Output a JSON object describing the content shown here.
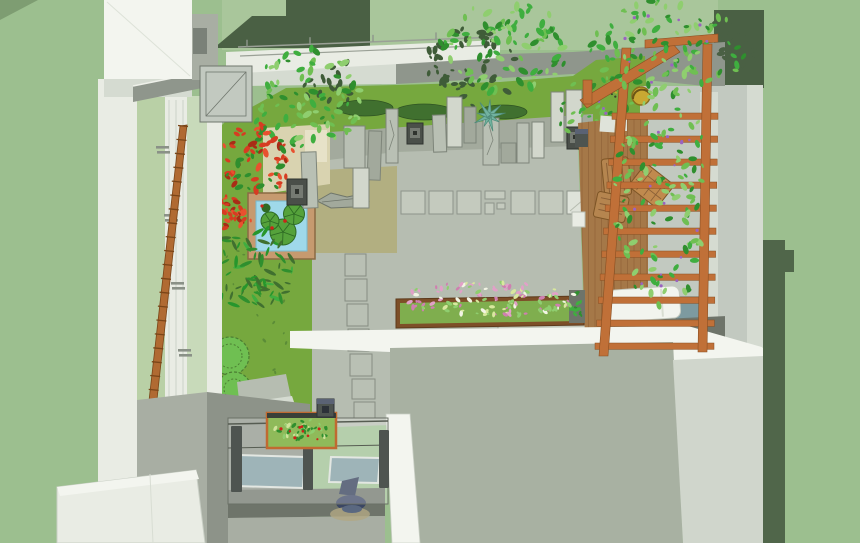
{
  "meta": {
    "width": 860,
    "height": 543
  },
  "scene": {
    "description": "Axonometric 3D rendering of a courtyard roof garden beside a glazed house facade",
    "objects": [
      {
        "name": "house-facade",
        "color": "wall_white"
      },
      {
        "name": "glass-curtain-wall",
        "color": "window_green"
      },
      {
        "name": "leaning-ladder",
        "color": "ladder"
      },
      {
        "name": "lawn",
        "color": "lawn"
      },
      {
        "name": "square-pond-with-lilypads",
        "color": "pond_water"
      },
      {
        "name": "red-maple-shrubs",
        "color": "red1"
      },
      {
        "name": "standing-stones",
        "color": "stone"
      },
      {
        "name": "stone-lanterns",
        "color": "lantern"
      },
      {
        "name": "agave-plant",
        "color": "agave"
      },
      {
        "name": "moss-mounds",
        "color": "moss"
      },
      {
        "name": "gray-patio-with-pavers",
        "color": "patio"
      },
      {
        "name": "stepping-stones",
        "color": "stone"
      },
      {
        "name": "flowering-planter",
        "color": "planter_green"
      },
      {
        "name": "wood-deck",
        "color": "deck"
      },
      {
        "name": "pergola-trellis-with-vines",
        "color": "pergola"
      },
      {
        "name": "white-lounge-bed",
        "color": "white_furniture"
      },
      {
        "name": "wooden-chairs",
        "color": "chair_wood"
      },
      {
        "name": "glass-lightwell",
        "color": "glass_teal"
      },
      {
        "name": "aquarium-planter-box",
        "color": "aqua_green"
      },
      {
        "name": "lower-roof",
        "color": "roof"
      }
    ]
  },
  "palette": {
    "background": "#9cbf8f",
    "corner_shade": "#7e9d72",
    "hedge_light": "#a9c69b",
    "dark_foliage": "#4a6044",
    "dark_foliage2": "#50664a",
    "band_gray": "#8f968c",
    "wall_white": "#e9ece4",
    "wall_bright": "#f3f5ef",
    "wall_light": "#d5dbd1",
    "wall_gray": "#c2c9c0",
    "wall_mid": "#a8aea3",
    "wall_dark": "#8d9389",
    "window_dark": "#7a8178",
    "window_green": "#b9d0a6",
    "window_green2": "#c8daba",
    "lawn": "#76a83e",
    "patio": "#b6bdb1",
    "patio_dark": "#a3aa9d",
    "olive": "#b2af81",
    "tan": "#d9d3b0",
    "tan_light": "#e7e2c8",
    "paver": "#c4cabe",
    "paver_light": "#dfe3da",
    "stone": "#b9c0b4",
    "stone_light": "#d2d7cc",
    "stone_dark": "#a2a99c",
    "stone_outline": "#7e857a",
    "roof": "#a8b1a2",
    "parapet": "#d0d6cc",
    "pergola": "#c07038",
    "pergola_dark": "#8a4f22",
    "ladder": "#b06a32",
    "deck": "#a57848",
    "deck_line": "#875c33",
    "wood_frame": "#7d4f28",
    "planter_green": "#7fae4e",
    "pond_frame": "#c69a6f",
    "pond_water": "#9fd9ea",
    "lily": "#55a23b",
    "lily_dark": "#2e6b24",
    "leaf1": "#3fae3f",
    "leaf2": "#6fbf52",
    "leaf3": "#2f8f2e",
    "leaf4": "#8fce6f",
    "leaf_dark": "#3f5c38",
    "fern": "#27962c",
    "moss": "#40702f",
    "red1": "#d63c22",
    "red2": "#e8512f",
    "red3": "#a82c16",
    "flower_pink": "#e2a0c8",
    "flower_pink2": "#cf7fb0",
    "flower_light": "#d8e89e",
    "flower_white": "#f2f4e4",
    "purple": "#9a63c0",
    "agave": "#72b3a0",
    "bird_dark": "#3a3f2e",
    "yellow": "#c9a832",
    "lantern": "#4a4f49",
    "lantern_inner": "#757a72",
    "glass_teal": "#7d9aa0",
    "glass_tint": "rgba(255,255,255,0.26)",
    "post_dark": "#4e5450",
    "floor_dark": "#6e746a",
    "aqua_green": "#8fba5a",
    "aqua_leaf": "#cfe39a",
    "red_fruit": "#cc2418",
    "navy": "#3a4663",
    "navy2": "#2e3a56",
    "navy3": "#5a6880",
    "shadow_tan": "#b2a883",
    "white_furniture": "#f2f4ee",
    "chair_wood": "#b5854f",
    "chair_wood2": "#c08a4e",
    "shadow_soft": "#8a9183"
  },
  "foliage_clusters": [
    {
      "name": "shadow-canopy",
      "cx": 472,
      "cy": 68,
      "rx": 48,
      "ry": 40,
      "count": 48,
      "smin": 2,
      "smax": 5,
      "shape": "leaf",
      "colors": [
        "leaf_dark"
      ],
      "seed": 7
    },
    {
      "name": "shadow-tree-left",
      "cx": 332,
      "cy": 82,
      "rx": 30,
      "ry": 26,
      "count": 20,
      "smin": 2,
      "smax": 4.5,
      "shape": "leaf",
      "colors": [
        "leaf_dark"
      ],
      "seed": 11
    },
    {
      "name": "pergola-shadow-leaves",
      "cx": 733,
      "cy": 42,
      "rx": 26,
      "ry": 30,
      "count": 26,
      "smin": 2,
      "smax": 4.5,
      "shape": "leaf",
      "colors": [
        "dark_foliage"
      ],
      "seed": 89
    },
    {
      "name": "lawn-specks",
      "cx": 260,
      "cy": 300,
      "rx": 48,
      "ry": 115,
      "count": 22,
      "smin": 1,
      "smax": 2.4,
      "shape": "leaf",
      "colors": [
        "moss"
      ],
      "seed": 59,
      "opacity": 0.5
    },
    {
      "name": "tree-left",
      "cx": 306,
      "cy": 98,
      "rx": 56,
      "ry": 50,
      "count": 80,
      "smin": 2.2,
      "smax": 5.5,
      "shape": "leaf",
      "colors": [
        "leaf1",
        "leaf2",
        "leaf3",
        "leaf4"
      ],
      "seed": 13
    },
    {
      "name": "tree-center",
      "cx": 505,
      "cy": 47,
      "rx": 68,
      "ry": 46,
      "count": 90,
      "smin": 2.2,
      "smax": 5.5,
      "shape": "leaf",
      "colors": [
        "leaf1",
        "leaf3",
        "leaf2",
        "leaf4"
      ],
      "seed": 17
    },
    {
      "name": "shrubs-right",
      "cx": 602,
      "cy": 112,
      "rx": 46,
      "ry": 36,
      "count": 55,
      "smin": 2,
      "smax": 5,
      "shape": "leaf",
      "colors": [
        "leaf2",
        "leaf3",
        "leaf1"
      ],
      "seed": 19
    },
    {
      "name": "shrubs-right-flowers",
      "cx": 604,
      "cy": 116,
      "rx": 42,
      "ry": 32,
      "count": 10,
      "smin": 2,
      "smax": 3.4,
      "shape": "dot",
      "colors": [
        "purple"
      ],
      "seed": 23
    },
    {
      "name": "red-tree-large",
      "cx": 258,
      "cy": 159,
      "rx": 37,
      "ry": 34,
      "count": 70,
      "smin": 2,
      "smax": 5,
      "shape": "leaf",
      "colors": [
        "red1",
        "red2",
        "red3",
        "red1",
        "leaf3"
      ],
      "seed": 43
    },
    {
      "name": "red-tree-small",
      "cx": 231,
      "cy": 215,
      "rx": 21,
      "ry": 19,
      "count": 40,
      "smin": 1.8,
      "smax": 4.2,
      "shape": "leaf",
      "colors": [
        "red1",
        "red2",
        "red3"
      ],
      "seed": 47
    },
    {
      "name": "fern-left",
      "cx": 251,
      "cy": 269,
      "rx": 44,
      "ry": 40,
      "count": 70,
      "smin": 3,
      "smax": 7,
      "shape": "frond",
      "colors": [
        "fern",
        "leaf3",
        "leaf1",
        "moss"
      ],
      "seed": 53
    },
    {
      "name": "planter-flowers",
      "cx": 489,
      "cy": 299,
      "rx": 91,
      "ry": 17,
      "count": 115,
      "smin": 1.5,
      "smax": 3.4,
      "shape": "leaf",
      "colors": [
        "flower_light",
        "flower_pink",
        "flower_pink2",
        "flower_white",
        "leaf4"
      ],
      "seed": 61
    },
    {
      "name": "deck-pot-plants",
      "cx": 577,
      "cy": 306,
      "rx": 6,
      "ry": 14,
      "count": 14,
      "smin": 1.6,
      "smax": 3,
      "shape": "leaf",
      "colors": [
        "leaf3",
        "leaf1"
      ],
      "seed": 73
    },
    {
      "name": "bird-ornament",
      "cx": 612,
      "cy": 90,
      "rx": 10,
      "ry": 8,
      "count": 7,
      "smin": 1.5,
      "smax": 2.6,
      "shape": "dot",
      "colors": [
        "bird_dark"
      ],
      "seed": 79
    },
    {
      "name": "bird-ornament-accent",
      "cx": 617,
      "cy": 95,
      "rx": 6,
      "ry": 5,
      "count": 3,
      "smin": 1.4,
      "smax": 2,
      "shape": "dot",
      "colors": [
        "yellow"
      ],
      "seed": 83
    },
    {
      "name": "vine-top",
      "cx": 668,
      "cy": 46,
      "rx": 78,
      "ry": 50,
      "count": 100,
      "smin": 2.2,
      "smax": 5.2,
      "shape": "leaf",
      "colors": [
        "leaf1",
        "leaf2",
        "leaf3",
        "leaf4"
      ],
      "seed": 29
    },
    {
      "name": "vine-top-flowers",
      "cx": 660,
      "cy": 50,
      "rx": 60,
      "ry": 40,
      "count": 9,
      "smin": 2,
      "smax": 3.2,
      "shape": "dot",
      "colors": [
        "purple"
      ],
      "seed": 31
    },
    {
      "name": "vine-column",
      "cx": 663,
      "cy": 196,
      "rx": 48,
      "ry": 112,
      "count": 110,
      "smin": 2,
      "smax": 5,
      "shape": "leaf",
      "colors": [
        "leaf1",
        "leaf2",
        "leaf4",
        "leaf3"
      ],
      "seed": 37
    },
    {
      "name": "vine-column-flowers",
      "cx": 664,
      "cy": 200,
      "rx": 42,
      "ry": 102,
      "count": 15,
      "smin": 2,
      "smax": 3.2,
      "shape": "dot",
      "colors": [
        "purple"
      ],
      "seed": 41
    },
    {
      "name": "aquarium-plants",
      "cx": 301,
      "cy": 430,
      "rx": 30,
      "ry": 12,
      "count": 40,
      "smin": 1.6,
      "smax": 3.2,
      "shape": "leaf",
      "colors": [
        "aqua_leaf",
        "leaf4",
        "leaf3"
      ],
      "seed": 67
    },
    {
      "name": "aquarium-fruits",
      "cx": 301,
      "cy": 431,
      "rx": 28,
      "ry": 11,
      "count": 9,
      "smin": 2,
      "smax": 3,
      "shape": "dot",
      "colors": [
        "red_fruit"
      ],
      "seed": 71
    }
  ]
}
